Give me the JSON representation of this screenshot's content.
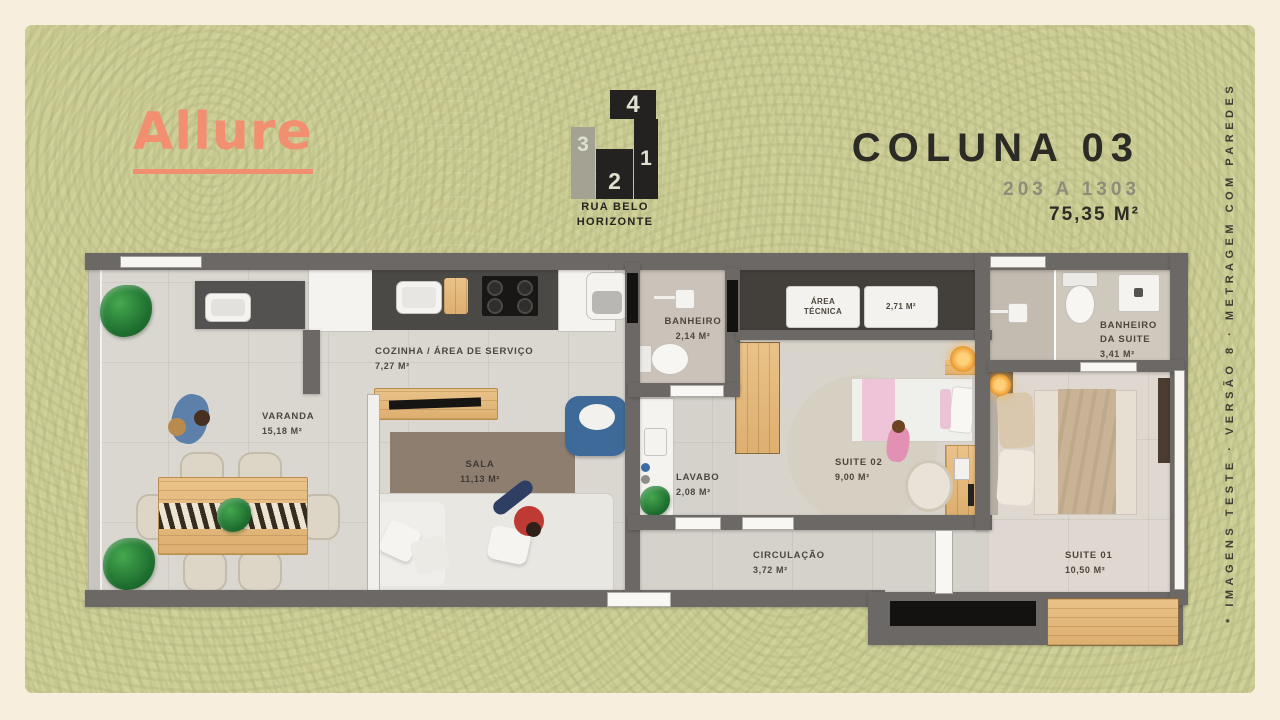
{
  "brand": {
    "logo": "Allure"
  },
  "locator": {
    "blocks": [
      "4",
      "3",
      "2",
      "1"
    ],
    "street_line1": "RUA BELO",
    "street_line2": "HORIZONTE"
  },
  "header": {
    "title": "COLUNA 03",
    "units": "203 A 1303",
    "area": "75,35 M²"
  },
  "side_note": "* IMAGENS TESTE · VERSÃO 8 · METRAGEM COM PAREDES",
  "rooms": [
    {
      "id": "varanda",
      "name": "VARANDA",
      "area": "15,18 M²"
    },
    {
      "id": "cozinha",
      "name": "COZINHA / ÁREA DE SERVIÇO",
      "area": "7,27 M²"
    },
    {
      "id": "sala",
      "name": "SALA",
      "area": "11,13 M²"
    },
    {
      "id": "banheiro",
      "name": "BANHEIRO",
      "area": "2,14 M²"
    },
    {
      "id": "area_tecnica",
      "name": "ÁREA TÉCNICA",
      "area": "2,71 M²"
    },
    {
      "id": "lavabo",
      "name": "LAVABO",
      "area": "2,08 M²"
    },
    {
      "id": "suite02",
      "name": "SUITE 02",
      "area": "9,00 M²"
    },
    {
      "id": "banheiro_suite",
      "name": "BANHEIRO DA SUITE",
      "area": "3,41 M²"
    },
    {
      "id": "suite01",
      "name": "SUITE 01",
      "area": "10,50 M²"
    },
    {
      "id": "circulacao",
      "name": "CIRCULAÇÃO",
      "area": "3,72 M²"
    }
  ],
  "palette": {
    "brand_coral": "#F28F70",
    "panel_green": "#CDCF97",
    "outer_cream": "#F8EEDD",
    "wall_gray": "#6B6865",
    "wood": "#E6BC82"
  }
}
